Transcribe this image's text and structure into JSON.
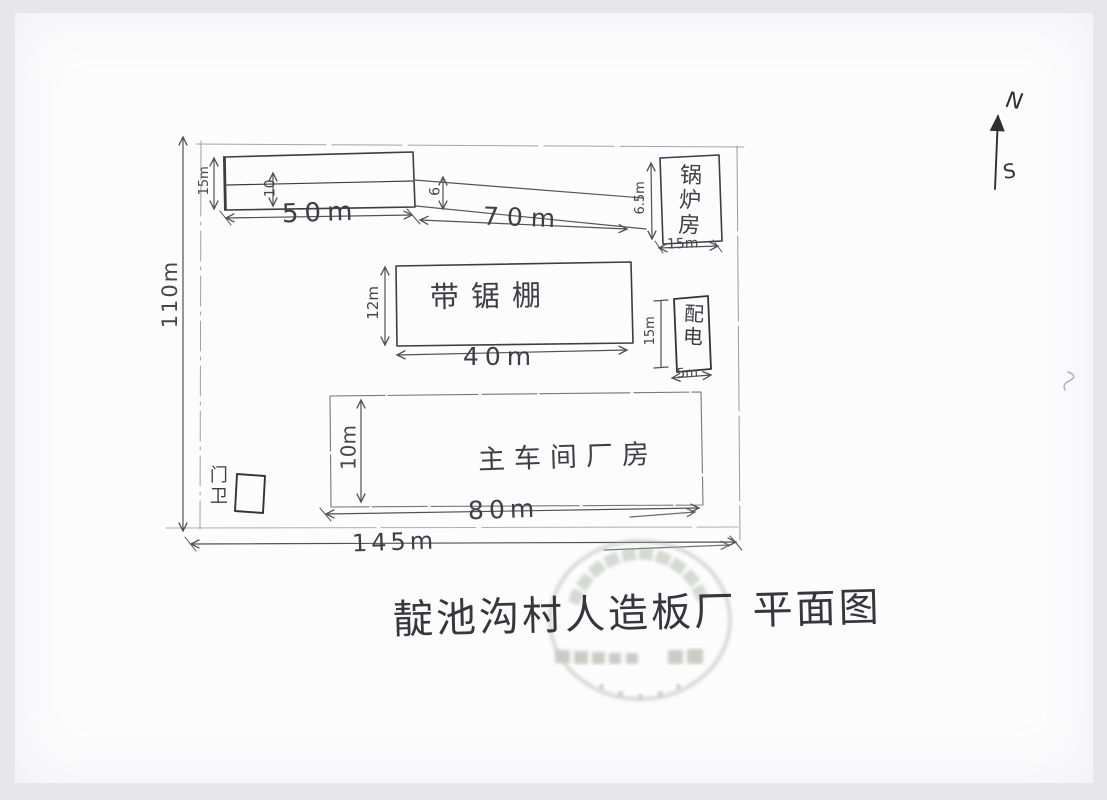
{
  "compass": {
    "north": "N",
    "south": "S"
  },
  "site": {
    "width": "145m",
    "height": "110m"
  },
  "strip_building": {
    "height": "15m",
    "inner_height": "10",
    "width": "50m"
  },
  "yard": {
    "road_length": "70m",
    "road_width": "6"
  },
  "boiler_room": {
    "name": "锅炉房",
    "height": "6.5m",
    "width": "15m"
  },
  "band_saw_shed": {
    "name": "带锯棚",
    "height": "12m",
    "width": "40m"
  },
  "power_room": {
    "name": "配电",
    "height": "15m",
    "width": "5m"
  },
  "main_workshop": {
    "name": "主车间厂房",
    "height": "10m",
    "width": "80m"
  },
  "gatehouse": {
    "name": "门卫"
  },
  "title": "靛池沟村人造板厂 平面图",
  "stamp": {
    "shape": "circular seal",
    "legible": false
  }
}
